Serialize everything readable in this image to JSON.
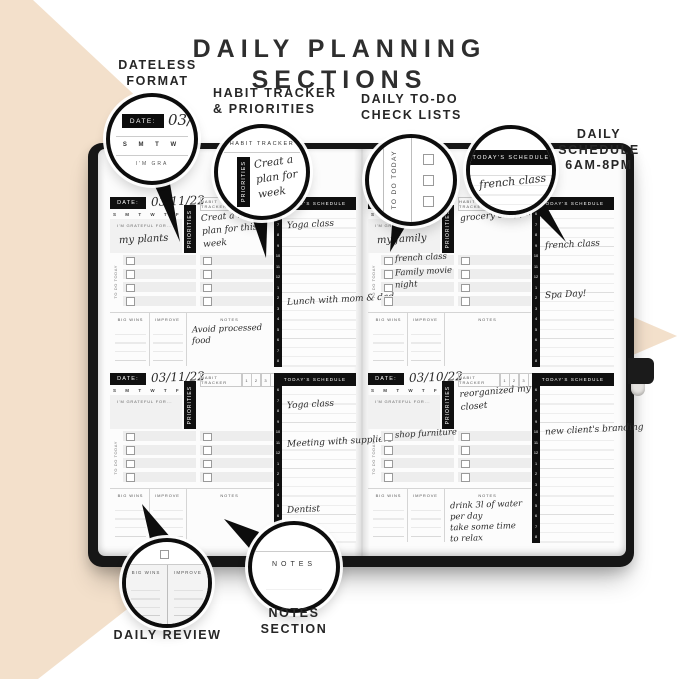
{
  "title": {
    "line1": "DAILY PLANNING",
    "line2": "SECTIONS"
  },
  "annotations": {
    "dateless": {
      "lines": [
        "DATELESS",
        "FORMAT"
      ]
    },
    "habit": {
      "lines": [
        "HABIT TRACKER",
        "& PRIORITIES"
      ]
    },
    "todo": {
      "lines": [
        "DAILY  TO-DO",
        "CHECK LISTS"
      ]
    },
    "schedule": {
      "lines": [
        "DAILY",
        "SCHEDULE",
        "6AM-8PM"
      ]
    },
    "review": {
      "lines": [
        "DAILY REVIEW"
      ]
    },
    "notes": {
      "lines": [
        "NOTES",
        "SECTION"
      ]
    }
  },
  "callouts": {
    "dateless": {
      "date_label": "DATE:",
      "date_value": "03/",
      "days": "S M T W",
      "grateful": "I'M GRA"
    },
    "habit": {
      "header": "HABIT TRACKER",
      "tab": "PRIORITIES",
      "lines": [
        "Creat a",
        "plan for",
        "week"
      ]
    },
    "todo": {
      "vertical": "TO DO TODAY"
    },
    "schedule": {
      "banner": "TODAY'S SCHEDULE",
      "entry": "french class"
    },
    "review": {
      "left": "BIG WINS",
      "right": "IMPROVE"
    },
    "notes": {
      "header": "NOTES"
    }
  },
  "planner": {
    "labels": {
      "date": "DATE:",
      "habit_tracker": "HABIT TRACKER",
      "tracker_numbers": [
        "1",
        "2",
        "3",
        "4"
      ],
      "days_letters": [
        "S",
        "M",
        "T",
        "W",
        "T",
        "F",
        "S"
      ],
      "grateful": "I'M GRATEFUL FOR...",
      "priorities": "PRIORITIES",
      "todo": "TO DO TODAY",
      "big_wins": "BIG WINS",
      "improve": "IMPROVE",
      "notes": "NOTES",
      "schedule": "TODAY'S SCHEDULE"
    },
    "times": [
      "6",
      "7",
      "8",
      "9",
      "10",
      "11",
      "12",
      "1",
      "2",
      "3",
      "4",
      "5",
      "6",
      "7",
      "8"
    ],
    "sections": [
      {
        "date": "03/11/22",
        "grateful": "my plants",
        "priorities": [
          "Creat a meal",
          "plan for this",
          "week"
        ],
        "todo": [],
        "notes": [
          "Avoid processed",
          "food"
        ],
        "schedule": [
          {
            "text": "Yoga class",
            "top": 10
          },
          {
            "text": "Lunch with mom & dad",
            "top": 85
          }
        ]
      },
      {
        "date": "",
        "grateful": "my family",
        "priorities": [
          "grocery shopping"
        ],
        "todo": [
          {
            "row": 0,
            "text": "french class"
          },
          {
            "row": 1,
            "text": "Family movie"
          },
          {
            "row": 2,
            "text": "night"
          }
        ],
        "notes": [],
        "schedule": [
          {
            "text": "french class",
            "top": 30
          },
          {
            "text": "Spa Day!",
            "top": 80
          }
        ]
      },
      {
        "date": "03/11/22",
        "grateful": "",
        "priorities": [],
        "todo": [],
        "notes": [],
        "schedule": [
          {
            "text": "Yoga class",
            "top": 14
          },
          {
            "text": "Meeting with suppliers",
            "top": 51
          },
          {
            "text": "Dentist",
            "top": 119
          }
        ]
      },
      {
        "date": "03/10/22",
        "grateful": "",
        "priorities": [
          "reorganized my",
          "closet"
        ],
        "todo": [
          {
            "row": 0,
            "text": "shop furniture"
          }
        ],
        "notes": [
          "drink 3l of water",
          "per day",
          "take some time",
          "to relax"
        ],
        "schedule": [
          {
            "text": "new client's branding",
            "top": 39
          }
        ]
      }
    ]
  },
  "colors": {
    "beige": "#F3E0CB",
    "black": "#111111",
    "paper": "#FFFFFF"
  }
}
